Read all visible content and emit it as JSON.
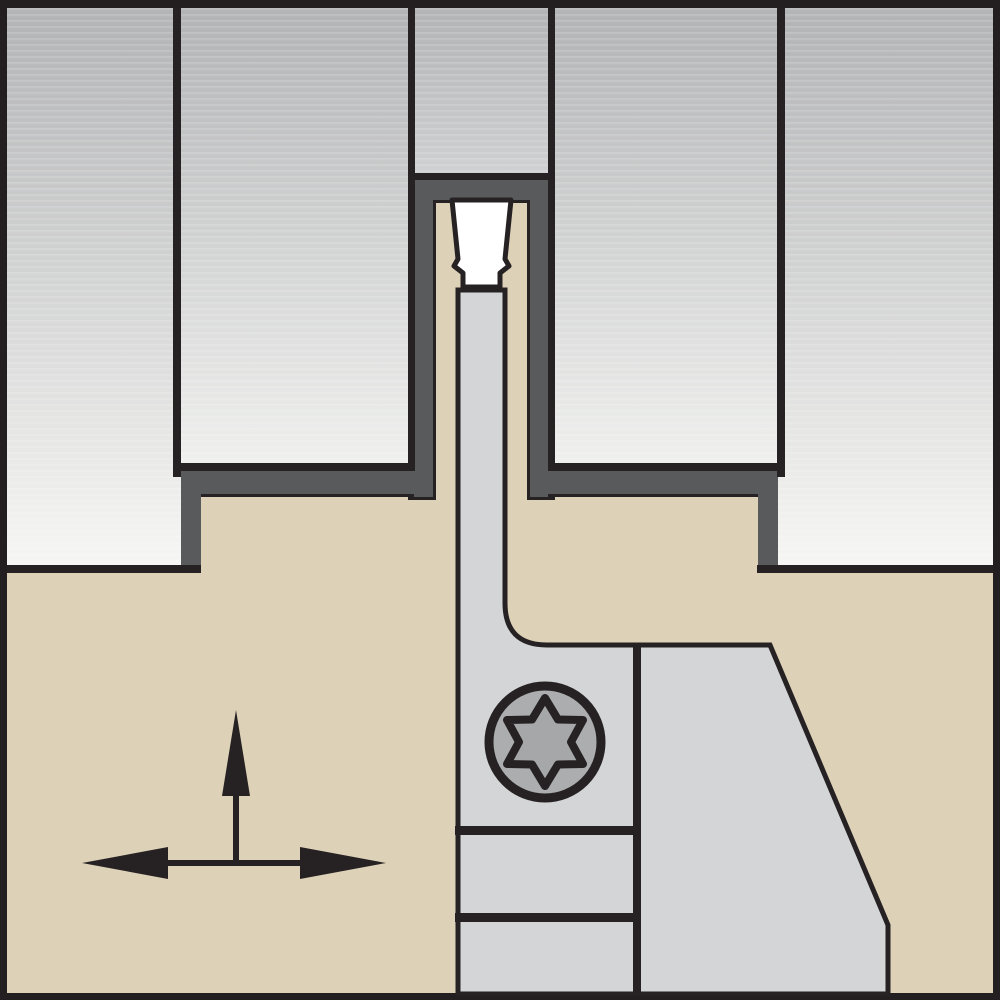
{
  "figure": {
    "title": "Cut-off / grooving tool in workpiece - cross-section diagram",
    "type": "technical-line-illustration",
    "parts": {
      "workpiece": "gray gradient blocks (material being machined)",
      "groove": "charcoal machined groove and shoulder steps",
      "insert": "white grooving insert clamped at top of blade",
      "blade": "gray cut-off blade reaching into the groove",
      "holder": "tan tool holder / support block body",
      "screw": "torx-clamp-screw-icon",
      "arrows": "feed-direction-arrows-icon (up + left-right)"
    },
    "visible_text": ""
  },
  "colors": {
    "frame": "#231f20",
    "ink": "#262223",
    "tan": "#ddd1b7",
    "charcoal": "#595a5c",
    "steel": "#d4d5d7",
    "insert_white": "#ffffff",
    "screw_body": "#abadaf",
    "screw_star": "#a5a7a9",
    "wp_top": "#b2b3b5",
    "wp_bottom_tall": "#f6f6f4",
    "wp_bottom_mid": "#eff0ee",
    "wp_bottom_stub": "#ced0d2"
  }
}
